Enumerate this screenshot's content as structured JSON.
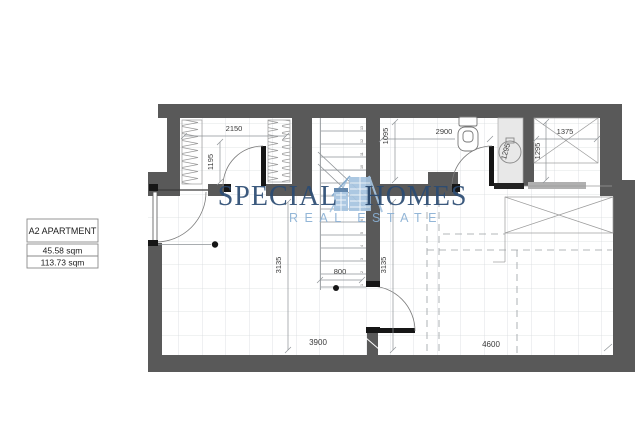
{
  "logo": {
    "brand_left": "SPECIAL",
    "brand_right": "HOMES",
    "subtitle": "REAL ESTATE",
    "color_dark": "#2b4b73",
    "color_light": "#8ab0d4",
    "icon": "buildings-icon"
  },
  "label_box": {
    "title": "A2 APARTMENT",
    "area_1": "45.58 sqm",
    "area_2": "113.73 sqm"
  },
  "dims": {
    "closet_width": "2150",
    "closet_depth": "1195",
    "bath_width": "2900",
    "bath_depth": "1095",
    "storage_width": "1375",
    "storage_depth": "1295",
    "shaft_depth": "1295",
    "hall_depth": "3135",
    "stair_width": "800",
    "bedroom_depth": "3135",
    "living_width": "3900",
    "bedroom_width": "4600"
  },
  "stairs": {
    "steps": [
      "1",
      "2",
      "3",
      "4",
      "5",
      "6",
      "7",
      "8",
      "9",
      "10",
      "11",
      "12",
      "13"
    ]
  },
  "colors": {
    "wall": "#595959",
    "black_fitting": "#161616",
    "grid": "#d7dbde",
    "dashed": "#9aa0a4",
    "shaft_fill": "#e8e8e8"
  }
}
